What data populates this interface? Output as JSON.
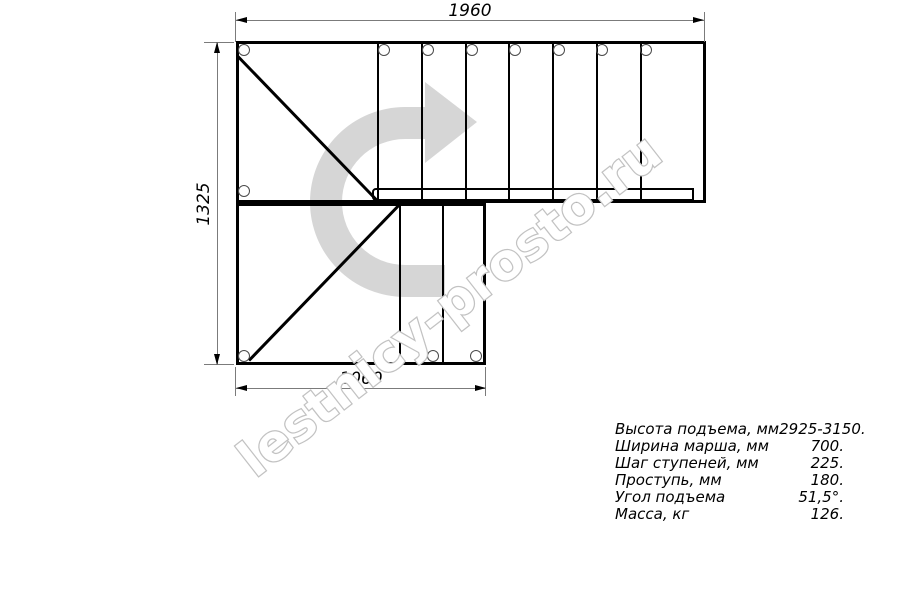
{
  "drawing_type": "staircase-plan",
  "dimensions": {
    "top_width_mm": "1960",
    "left_height_mm": "1325",
    "bottom_width_mm": "1060"
  },
  "watermark": {
    "text": "lestnicy-prosto.ru"
  },
  "specs": {
    "rows": [
      {
        "label": "Высота подъема, мм",
        "value": "2925-3150."
      },
      {
        "label": "Ширина марша, мм",
        "value": "700."
      },
      {
        "label": "Шаг ступеней, мм",
        "value": "225."
      },
      {
        "label": "Проступь, мм",
        "value": "180."
      },
      {
        "label": "Угол подъема",
        "value": "51,5°."
      },
      {
        "label": "Масса, кг",
        "value": "126."
      }
    ]
  },
  "colors": {
    "line": "#000000",
    "dimension_line": "#7b7b7b",
    "watermark_arrow": "#d6d6d6",
    "watermark_outline": "#c2c2c2"
  }
}
